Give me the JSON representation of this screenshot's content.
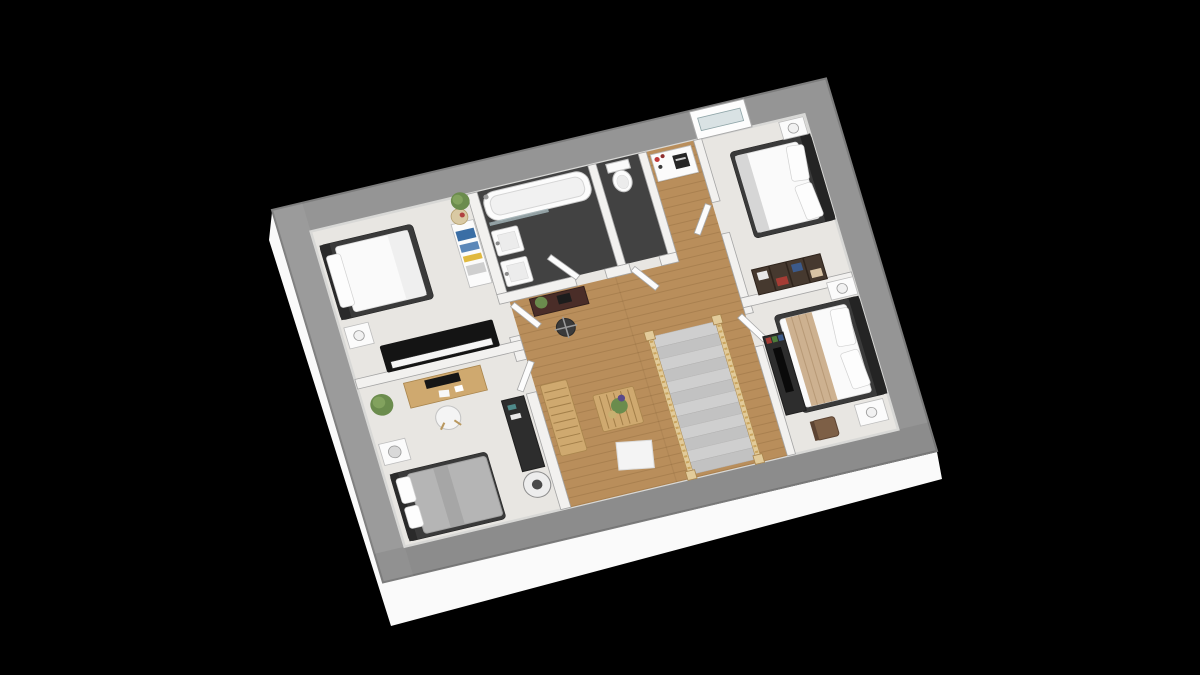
{
  "scene": {
    "type": "floor-plan-3d-render",
    "background": "#000000",
    "description": "Isometric 3D floor plan render of an upstairs level with four bedrooms, a bathroom, a separate WC, and a central landing with a carpeted staircase and wood floor, shown tilted on a black background"
  },
  "palette": {
    "wall_exterior": "#959595",
    "wall_outline": "#7d7d7d",
    "wall_interior": "#f2f1ef",
    "wall_interior_stroke": "#a5a5a5",
    "floor_carpet": "#e8e6e2",
    "floor_wood": "#b98e5b",
    "floor_tile": "#424242",
    "slab": "#fafafa",
    "wood_light": "#cfa96f",
    "wood_stroke": "#a9854d",
    "furniture_dark": "#2d2d2d",
    "bed_frame": "#3a3a3a",
    "bedding_white": "#fafafa",
    "blanket_tan": "#cdb190",
    "blanket_gray": "#b5b5b5",
    "plant_green": "#6b8c4d",
    "accent_red": "#c03a3a",
    "espresso": "#46392f",
    "glass_blue": "#d9e2e4",
    "stair_wood": "#e2cb9a"
  },
  "rooms": [
    {
      "id": "bedroom-1",
      "name": "Bedroom top-left",
      "floor": "carpet",
      "furniture": [
        "double bed with dark frame",
        "nightstand with lamp",
        "black upright piano",
        "white bookcase with blue books",
        "woven decorative plate",
        "potted plant"
      ]
    },
    {
      "id": "bathroom",
      "name": "Bathroom",
      "floor": "dark tile",
      "furniture": [
        "bathtub with glass screen",
        "shower fixture",
        "two washbasins",
        "open door"
      ]
    },
    {
      "id": "wc",
      "name": "WC",
      "floor": "dark tile",
      "furniture": [
        "toilet",
        "open door"
      ]
    },
    {
      "id": "hall-nook",
      "name": "Hall nook",
      "floor": "wood",
      "furniture": [
        "white cabinet with red decor and dark sign"
      ]
    },
    {
      "id": "bedroom-2",
      "name": "Bedroom top-right",
      "floor": "carpet",
      "furniture": [
        "double bed with dark headboard",
        "nightstand with lamp",
        "espresso bookshelf with books",
        "window in north wall"
      ]
    },
    {
      "id": "bedroom-3",
      "name": "Bedroom right",
      "floor": "carpet",
      "furniture": [
        "double bed with tan throw",
        "two nightstands with lamps",
        "media sideboard with TV panel",
        "wooden chair"
      ]
    },
    {
      "id": "bedroom-4",
      "name": "Bedroom bottom-left",
      "floor": "carpet",
      "furniture": [
        "bed with gray duvet",
        "nightstand with gray lamp",
        "wooden desk with monitor",
        "white desk chair",
        "potted plant",
        "dark sideboard",
        "drum floor lamp"
      ]
    },
    {
      "id": "landing",
      "name": "Landing",
      "floor": "wood",
      "furniture": [
        "staircase with gray carpet and wood balustrade",
        "slatted wood bench",
        "coffee table with plant",
        "white floor mat",
        "small dark desk with laptop and plant",
        "swivel stool"
      ]
    }
  ]
}
